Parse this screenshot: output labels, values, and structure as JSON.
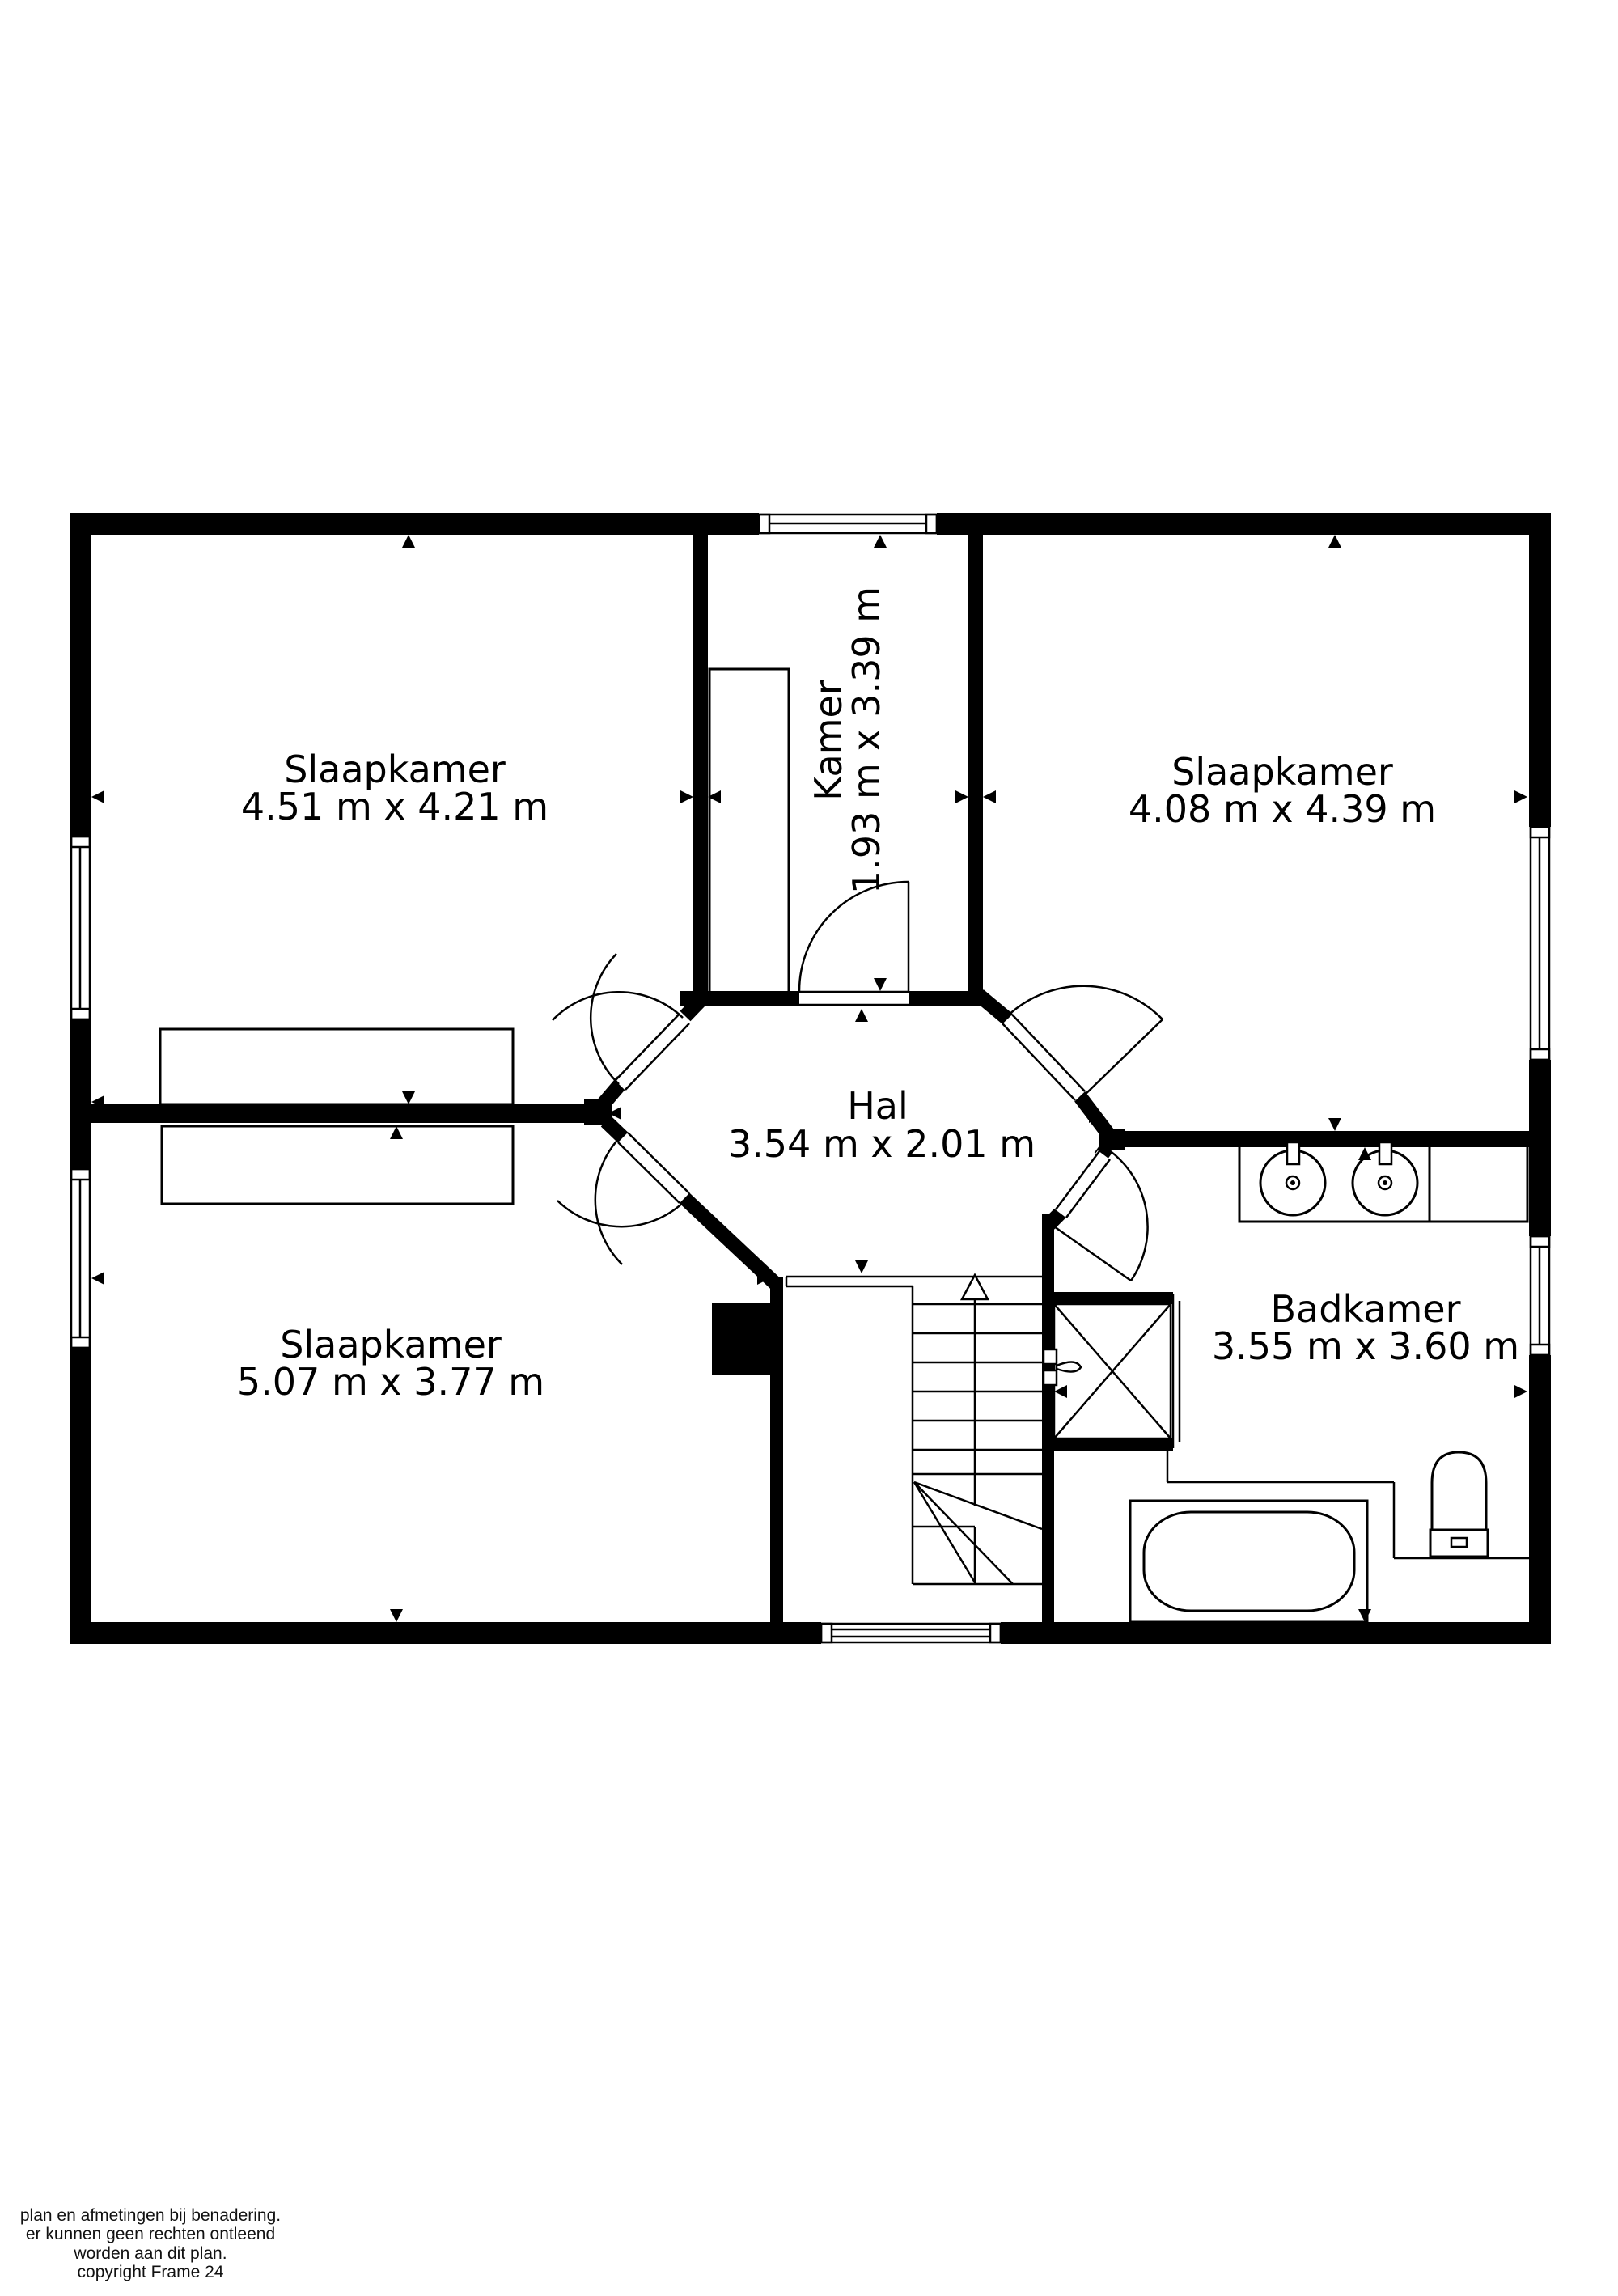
{
  "page": {
    "background": "#ffffff",
    "ink": "#000000",
    "type": "floor-plan"
  },
  "rooms": [
    {
      "id": "slaapkamer-top-left",
      "name": "Slaapkamer",
      "dims": "4.51 m x 4.21 m"
    },
    {
      "id": "kamer",
      "name": "Kamer",
      "dims": "1.93 m x 3.39 m"
    },
    {
      "id": "slaapkamer-top-right",
      "name": "Slaapkamer",
      "dims": "4.08 m x 4.39 m"
    },
    {
      "id": "hal",
      "name": "Hal",
      "dims": "3.54 m x 2.01 m"
    },
    {
      "id": "slaapkamer-bottom-left",
      "name": "Slaapkamer",
      "dims": "5.07 m x 3.77 m"
    },
    {
      "id": "badkamer",
      "name": "Badkamer",
      "dims": "3.55 m x 3.60 m"
    }
  ],
  "fixtures": [
    "stairs-with-winder",
    "double-washbasin",
    "shower",
    "toilet",
    "bathtub",
    "wardrobe",
    "bed-dresser",
    "chimney"
  ],
  "disclaimer": {
    "line1": "plan en afmetingen bij benadering.",
    "line2": "er kunnen geen rechten ontleend",
    "line3": "worden aan dit plan.",
    "line4": "copyright Frame 24"
  }
}
